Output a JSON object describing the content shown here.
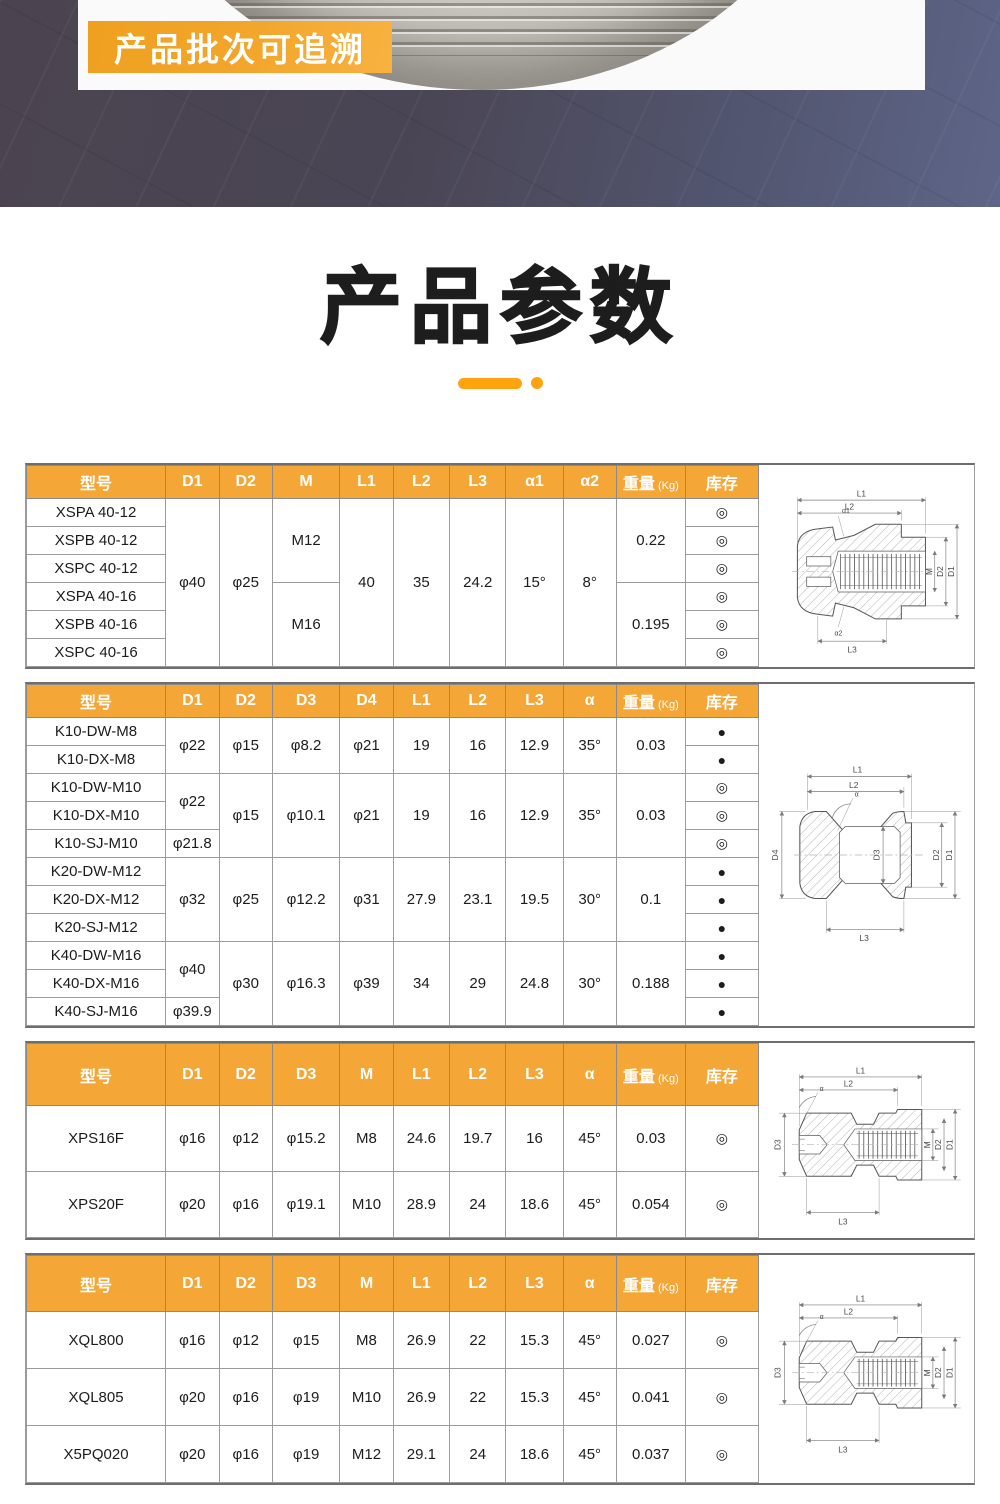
{
  "hero": {
    "badge": "产品批次可追溯"
  },
  "title": {
    "text": "产品参数"
  },
  "colors": {
    "accent_orange": "#F4A636",
    "badge_orange": "#F2A42C",
    "underline_orange": "#FFA30F",
    "hero_band_left": "#4B4450",
    "hero_band_right": "#5E6588",
    "title_color": "#1D1D1D"
  },
  "stock_symbols": {
    "in_stock": "◎",
    "filled": "●"
  },
  "tables": [
    {
      "headers": [
        {
          "label": "型号"
        },
        {
          "label": "D1"
        },
        {
          "label": "D2"
        },
        {
          "label": "M"
        },
        {
          "label": "L1"
        },
        {
          "label": "L2"
        },
        {
          "label": "L3"
        },
        {
          "label": "α1"
        },
        {
          "label": "α2"
        },
        {
          "label": "重量",
          "sub": "(Kg)"
        },
        {
          "label": "库存"
        }
      ],
      "rows": [
        [
          {
            "t": "XSPA 40-12"
          },
          {
            "t": "φ40",
            "rs": 6
          },
          {
            "t": "φ25",
            "rs": 6
          },
          {
            "t": "M12",
            "rs": 3
          },
          {
            "t": "40",
            "rs": 6
          },
          {
            "t": "35",
            "rs": 6
          },
          {
            "t": "24.2",
            "rs": 6
          },
          {
            "t": "15°",
            "rs": 6
          },
          {
            "t": "8°",
            "rs": 6
          },
          {
            "t": "0.22",
            "rs": 3
          },
          {
            "t": "◎"
          }
        ],
        [
          {
            "t": "XSPB 40-12"
          },
          {
            "t": "◎"
          }
        ],
        [
          {
            "t": "XSPC 40-12"
          },
          {
            "t": "◎"
          }
        ],
        [
          {
            "t": "XSPA 40-16"
          },
          {
            "t": "M16",
            "rs": 3
          },
          {
            "t": "0.195",
            "rs": 3
          },
          {
            "t": "◎"
          }
        ],
        [
          {
            "t": "XSPB 40-16"
          },
          {
            "t": "◎"
          }
        ],
        [
          {
            "t": "XSPC 40-16"
          },
          {
            "t": "◎"
          }
        ]
      ],
      "drawing": {
        "L1": "L1",
        "L2": "L2",
        "L3": "L3",
        "M": "M",
        "D2": "D2",
        "D1": "D1",
        "A1": "α1",
        "A2": "α2"
      }
    },
    {
      "headers": [
        {
          "label": "型号"
        },
        {
          "label": "D1"
        },
        {
          "label": "D2"
        },
        {
          "label": "D3"
        },
        {
          "label": "D4"
        },
        {
          "label": "L1"
        },
        {
          "label": "L2"
        },
        {
          "label": "L3"
        },
        {
          "label": "α"
        },
        {
          "label": "重量",
          "sub": "(Kg)"
        },
        {
          "label": "库存"
        }
      ],
      "rows": [
        [
          {
            "t": "K10-DW-M8"
          },
          {
            "t": "φ22",
            "rs": 2
          },
          {
            "t": "φ15",
            "rs": 2
          },
          {
            "t": "φ8.2",
            "rs": 2
          },
          {
            "t": "φ21",
            "rs": 2
          },
          {
            "t": "19",
            "rs": 2
          },
          {
            "t": "16",
            "rs": 2
          },
          {
            "t": "12.9",
            "rs": 2
          },
          {
            "t": "35°",
            "rs": 2
          },
          {
            "t": "0.03",
            "rs": 2
          },
          {
            "t": "●"
          }
        ],
        [
          {
            "t": "K10-DX-M8"
          },
          {
            "t": "●"
          }
        ],
        [
          {
            "t": "K10-DW-M10"
          },
          {
            "t": "φ22",
            "rs": 2
          },
          {
            "t": "φ15",
            "rs": 3
          },
          {
            "t": "φ10.1",
            "rs": 3
          },
          {
            "t": "φ21",
            "rs": 3
          },
          {
            "t": "19",
            "rs": 3
          },
          {
            "t": "16",
            "rs": 3
          },
          {
            "t": "12.9",
            "rs": 3
          },
          {
            "t": "35°",
            "rs": 3
          },
          {
            "t": "0.03",
            "rs": 3
          },
          {
            "t": "◎"
          }
        ],
        [
          {
            "t": "K10-DX-M10"
          },
          {
            "t": "◎"
          }
        ],
        [
          {
            "t": "K10-SJ-M10"
          },
          {
            "t": "φ21.8"
          },
          {
            "t": "◎"
          }
        ],
        [
          {
            "t": "K20-DW-M12"
          },
          {
            "t": "φ32",
            "rs": 3
          },
          {
            "t": "φ25",
            "rs": 3
          },
          {
            "t": "φ12.2",
            "rs": 3
          },
          {
            "t": "φ31",
            "rs": 3
          },
          {
            "t": "27.9",
            "rs": 3
          },
          {
            "t": "23.1",
            "rs": 3
          },
          {
            "t": "19.5",
            "rs": 3
          },
          {
            "t": "30°",
            "rs": 3
          },
          {
            "t": "0.1",
            "rs": 3
          },
          {
            "t": "●"
          }
        ],
        [
          {
            "t": "K20-DX-M12"
          },
          {
            "t": "●"
          }
        ],
        [
          {
            "t": "K20-SJ-M12"
          },
          {
            "t": "●"
          }
        ],
        [
          {
            "t": "K40-DW-M16"
          },
          {
            "t": "φ40",
            "rs": 2
          },
          {
            "t": "φ30",
            "rs": 3
          },
          {
            "t": "φ16.3",
            "rs": 3
          },
          {
            "t": "φ39",
            "rs": 3
          },
          {
            "t": "34",
            "rs": 3
          },
          {
            "t": "29",
            "rs": 3
          },
          {
            "t": "24.8",
            "rs": 3
          },
          {
            "t": "30°",
            "rs": 3
          },
          {
            "t": "0.188",
            "rs": 3
          },
          {
            "t": "●"
          }
        ],
        [
          {
            "t": "K40-DX-M16"
          },
          {
            "t": "●"
          }
        ],
        [
          {
            "t": "K40-SJ-M16"
          },
          {
            "t": "φ39.9"
          },
          {
            "t": "●"
          }
        ]
      ],
      "drawing": {
        "L1": "L1",
        "L2": "L2",
        "L3": "L3",
        "D4": "D4",
        "D3": "D3",
        "D2": "D2",
        "D1": "D1",
        "A": "α"
      }
    },
    {
      "headers": [
        {
          "label": "型号"
        },
        {
          "label": "D1"
        },
        {
          "label": "D2"
        },
        {
          "label": "D3"
        },
        {
          "label": "M"
        },
        {
          "label": "L1"
        },
        {
          "label": "L2"
        },
        {
          "label": "L3"
        },
        {
          "label": "α"
        },
        {
          "label": "重量",
          "sub": "(Kg)"
        },
        {
          "label": "库存"
        }
      ],
      "rows": [
        [
          {
            "t": "XPS16F"
          },
          {
            "t": "φ16"
          },
          {
            "t": "φ12"
          },
          {
            "t": "φ15.2"
          },
          {
            "t": "M8"
          },
          {
            "t": "24.6"
          },
          {
            "t": "19.7"
          },
          {
            "t": "16"
          },
          {
            "t": "45°"
          },
          {
            "t": "0.03"
          },
          {
            "t": "◎"
          }
        ],
        [
          {
            "t": "XPS20F"
          },
          {
            "t": "φ20"
          },
          {
            "t": "φ16"
          },
          {
            "t": "φ19.1"
          },
          {
            "t": "M10"
          },
          {
            "t": "28.9"
          },
          {
            "t": "24"
          },
          {
            "t": "18.6"
          },
          {
            "t": "45°"
          },
          {
            "t": "0.054"
          },
          {
            "t": "◎"
          }
        ]
      ],
      "drawing": {
        "L1": "L1",
        "L2": "L2",
        "L3": "L3",
        "D3": "D3",
        "M": "M",
        "D2": "D2",
        "D1": "D1",
        "A": "α"
      }
    },
    {
      "headers": [
        {
          "label": "型号"
        },
        {
          "label": "D1"
        },
        {
          "label": "D2"
        },
        {
          "label": "D3"
        },
        {
          "label": "M"
        },
        {
          "label": "L1"
        },
        {
          "label": "L2"
        },
        {
          "label": "L3"
        },
        {
          "label": "α"
        },
        {
          "label": "重量",
          "sub": "(Kg)"
        },
        {
          "label": "库存"
        }
      ],
      "rows": [
        [
          {
            "t": "XQL800"
          },
          {
            "t": "φ16"
          },
          {
            "t": "φ12"
          },
          {
            "t": "φ15"
          },
          {
            "t": "M8"
          },
          {
            "t": "26.9"
          },
          {
            "t": "22"
          },
          {
            "t": "15.3"
          },
          {
            "t": "45°"
          },
          {
            "t": "0.027"
          },
          {
            "t": "◎"
          }
        ],
        [
          {
            "t": "XQL805"
          },
          {
            "t": "φ20"
          },
          {
            "t": "φ16"
          },
          {
            "t": "φ19"
          },
          {
            "t": "M10"
          },
          {
            "t": "26.9"
          },
          {
            "t": "22"
          },
          {
            "t": "15.3"
          },
          {
            "t": "45°"
          },
          {
            "t": "0.041"
          },
          {
            "t": "◎"
          }
        ],
        [
          {
            "t": "X5PQ020"
          },
          {
            "t": "φ20"
          },
          {
            "t": "φ16"
          },
          {
            "t": "φ19"
          },
          {
            "t": "M12"
          },
          {
            "t": "29.1"
          },
          {
            "t": "24"
          },
          {
            "t": "18.6"
          },
          {
            "t": "45°"
          },
          {
            "t": "0.037"
          },
          {
            "t": "◎"
          }
        ]
      ],
      "drawing": {
        "L1": "L1",
        "L2": "L2",
        "L3": "L3",
        "D3": "D3",
        "M": "M",
        "D2": "D2",
        "D1": "D1",
        "A": "α"
      }
    }
  ]
}
